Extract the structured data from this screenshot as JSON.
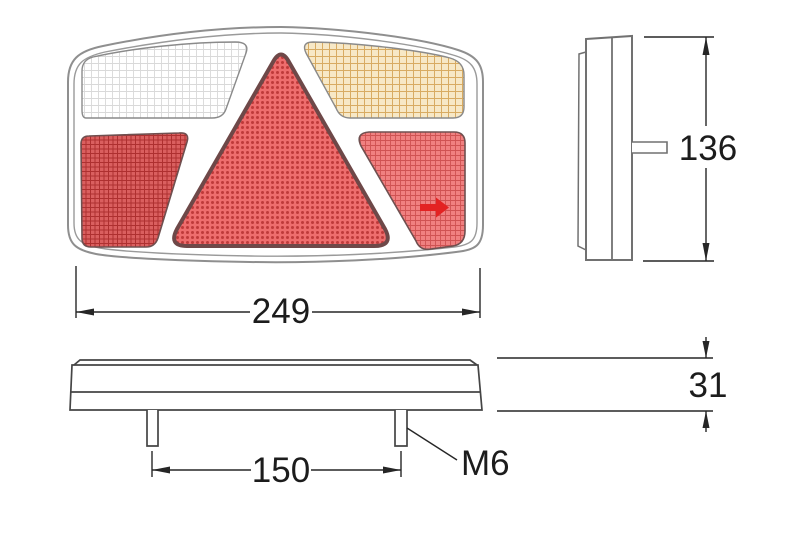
{
  "page": {
    "background": "#ffffff"
  },
  "drawing": {
    "type": "technical-dimension-drawing",
    "subject": "trailer-rear-combination-lamp",
    "labels": {
      "width_mm": "249",
      "height_mm": "136",
      "depth_mm": "31",
      "stud_spacing_mm": "150",
      "stud_thread": "M6"
    },
    "views": {
      "front": {
        "sections": [
          {
            "name": "top-left-white-section",
            "fill": "#ffffff",
            "pattern_line": "#d9d9d9",
            "pattern": "fine-grid"
          },
          {
            "name": "top-right-amber-section",
            "fill": "#f7e8c6",
            "pattern_line": "#d8ab62",
            "pattern": "plaid-grid"
          },
          {
            "name": "center-red-triangle",
            "fill": "#ee6d6d",
            "pattern_line": "#bf3a3a",
            "pattern": "dots"
          },
          {
            "name": "bottom-left-dark-red-section",
            "fill": "#da5f5f",
            "pattern_line": "#ae3030",
            "pattern": "dense-crosshatch"
          },
          {
            "name": "bottom-right-red-section",
            "fill": "#f08080",
            "pattern_line": "#cf5252",
            "pattern": "grid",
            "arrow_color": "#e32222"
          }
        ]
      },
      "side": {
        "visible_studs": 1
      },
      "bottom": {
        "visible_studs": 2
      }
    },
    "colors": {
      "front_frame_outline": "#8f8f8f",
      "side_outline": "#717171",
      "bottom_outline": "#454545",
      "section_outline": "#5f5f5f",
      "dimension_line": "#262626",
      "text": "#1c1c1c"
    }
  }
}
